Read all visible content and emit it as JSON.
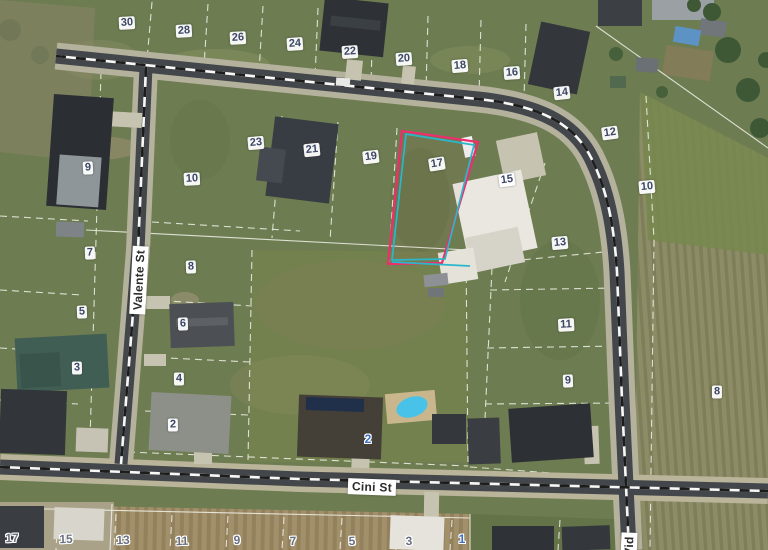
{
  "map": {
    "type": "aerial-cadastral-parcel-map",
    "streets": [
      "Valente St",
      "Cini St",
      "Vid"
    ],
    "highlight_colors": {
      "outer": "#ee2e6c",
      "inner": "#2bb7cb"
    },
    "highlighted_lot": "17",
    "labels": [
      {
        "t": "30",
        "x": 127,
        "y": 23,
        "r": -3,
        "s": "chip"
      },
      {
        "t": "28",
        "x": 184,
        "y": 31,
        "r": -3,
        "s": "chip"
      },
      {
        "t": "26",
        "x": 238,
        "y": 38,
        "r": -3,
        "s": "chip"
      },
      {
        "t": "24",
        "x": 295,
        "y": 44,
        "r": -4,
        "s": "chip"
      },
      {
        "t": "22",
        "x": 350,
        "y": 52,
        "r": -4,
        "s": "chip"
      },
      {
        "t": "20",
        "x": 404,
        "y": 59,
        "r": -4,
        "s": "chip"
      },
      {
        "t": "18",
        "x": 460,
        "y": 66,
        "r": -5,
        "s": "chip"
      },
      {
        "t": "16",
        "x": 512,
        "y": 73,
        "r": -4,
        "s": "chip"
      },
      {
        "t": "14",
        "x": 562,
        "y": 93,
        "r": -6,
        "s": "chip"
      },
      {
        "t": "12",
        "x": 610,
        "y": 133,
        "r": -8,
        "s": "chip"
      },
      {
        "t": "10",
        "x": 647,
        "y": 187,
        "r": -5,
        "s": "chip"
      },
      {
        "t": "23",
        "x": 256,
        "y": 143,
        "r": -5,
        "s": "chip"
      },
      {
        "t": "21",
        "x": 312,
        "y": 150,
        "r": -6,
        "s": "chip"
      },
      {
        "t": "19",
        "x": 371,
        "y": 157,
        "r": -7,
        "s": "chip"
      },
      {
        "t": "17",
        "x": 437,
        "y": 164,
        "r": -9,
        "s": "chip"
      },
      {
        "t": "15",
        "x": 507,
        "y": 180,
        "r": -8,
        "s": "chip"
      },
      {
        "t": "13",
        "x": 560,
        "y": 243,
        "r": -5,
        "s": "chip"
      },
      {
        "t": "11",
        "x": 566,
        "y": 325,
        "r": -3,
        "s": "chip"
      },
      {
        "t": "9",
        "x": 568,
        "y": 381,
        "r": -2,
        "s": "chip"
      },
      {
        "t": "8",
        "x": 717,
        "y": 392,
        "r": 0,
        "s": "chip"
      },
      {
        "t": "9",
        "x": 88,
        "y": 168,
        "r": -3,
        "s": "chip"
      },
      {
        "t": "10",
        "x": 192,
        "y": 179,
        "r": -3,
        "s": "chip"
      },
      {
        "t": "7",
        "x": 90,
        "y": 253,
        "r": -2,
        "s": "chip"
      },
      {
        "t": "8",
        "x": 191,
        "y": 267,
        "r": -2,
        "s": "chip"
      },
      {
        "t": "5",
        "x": 82,
        "y": 312,
        "r": -2,
        "s": "chip"
      },
      {
        "t": "6",
        "x": 183,
        "y": 324,
        "r": -2,
        "s": "chip"
      },
      {
        "t": "3",
        "x": 77,
        "y": 368,
        "r": -1,
        "s": "chip"
      },
      {
        "t": "4",
        "x": 179,
        "y": 379,
        "r": -1,
        "s": "chip"
      },
      {
        "t": "2",
        "x": 173,
        "y": 425,
        "r": -1,
        "s": "chip"
      },
      {
        "t": "2",
        "x": 368,
        "y": 439,
        "r": 0,
        "s": "house"
      },
      {
        "t": "1",
        "x": 462,
        "y": 539,
        "r": 0,
        "s": "house"
      },
      {
        "t": "17",
        "x": 12,
        "y": 538,
        "r": -2,
        "s": "halo"
      },
      {
        "t": "15",
        "x": 66,
        "y": 539,
        "r": -2,
        "s": "halo"
      },
      {
        "t": "13",
        "x": 123,
        "y": 540,
        "r": -2,
        "s": "halo"
      },
      {
        "t": "11",
        "x": 182,
        "y": 541,
        "r": -2,
        "s": "halo"
      },
      {
        "t": "9",
        "x": 237,
        "y": 540,
        "r": -2,
        "s": "halo"
      },
      {
        "t": "7",
        "x": 293,
        "y": 541,
        "r": -2,
        "s": "halo"
      },
      {
        "t": "5",
        "x": 352,
        "y": 541,
        "r": -2,
        "s": "halo"
      },
      {
        "t": "3",
        "x": 409,
        "y": 541,
        "r": -2,
        "s": "halo"
      },
      {
        "t": "Valente St",
        "x": 139,
        "y": 280,
        "r": -87,
        "s": "street"
      },
      {
        "t": "Cini St",
        "x": 372,
        "y": 487,
        "r": 2,
        "s": "street"
      },
      {
        "t": "Vid",
        "x": 629,
        "y": 546,
        "r": -88,
        "s": "street"
      }
    ]
  }
}
